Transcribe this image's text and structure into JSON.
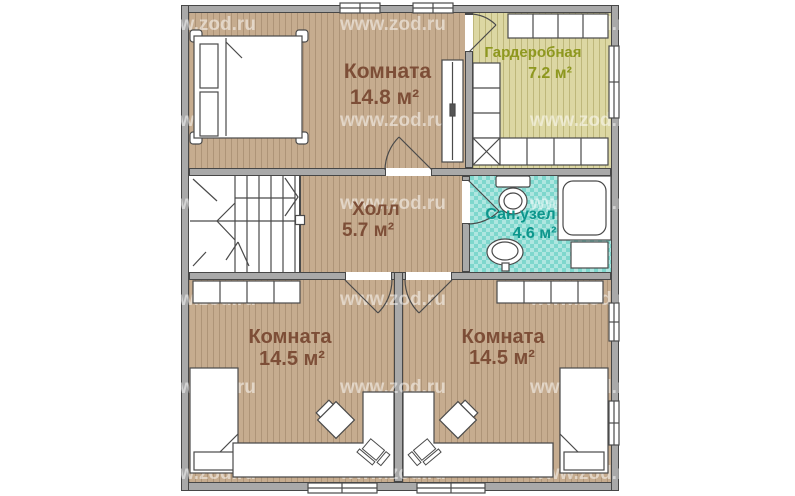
{
  "watermark": {
    "text": "www.zod.ru",
    "columns_x": [
      150,
      340,
      530
    ],
    "rows_y": [
      14,
      110,
      193,
      289,
      377,
      463
    ]
  },
  "colors": {
    "floor_wood": "#c6ac8f",
    "floor_wardrobe": "#dcd7a3",
    "floor_bath": "#7ed7cd",
    "wall": "#a9a9a9",
    "label_room": "#7d4e37",
    "label_wardrobe": "#8e981f",
    "label_bath": "#0d968c"
  },
  "rooms": [
    {
      "id": "room-top",
      "name": "Комната",
      "area": "14.8 м²"
    },
    {
      "id": "wardrobe",
      "name": "Гардеробная",
      "area": "7.2 м²"
    },
    {
      "id": "hall",
      "name": "Холл",
      "area": "5.7 м²"
    },
    {
      "id": "bathroom",
      "name": "Сан.узел",
      "area": "4.6 м²"
    },
    {
      "id": "room-bottom-left",
      "name": "Комната",
      "area": "14.5 м²"
    },
    {
      "id": "room-bottom-right",
      "name": "Комната",
      "area": "14.5 м²"
    }
  ]
}
